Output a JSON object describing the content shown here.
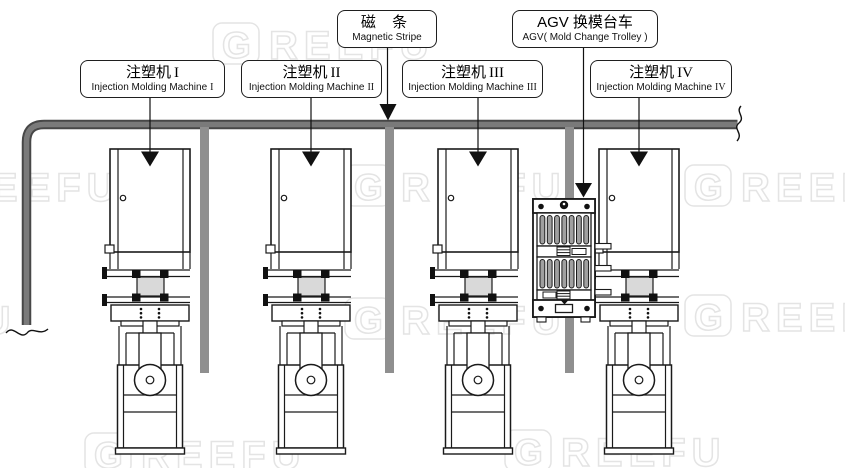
{
  "labels": {
    "magnetic_stripe": {
      "zh": "磁 条",
      "en": "Magnetic Stripe"
    },
    "agv_trolley": {
      "zh": "AGV 换模台车",
      "en": "AGV( Mold Change Trolley )"
    },
    "machines": [
      {
        "zh": "注塑机",
        "numeral": "I",
        "en": "Injection Molding Machine",
        "numeral_en": "I"
      },
      {
        "zh": "注塑机",
        "numeral": "II",
        "en": "Injection Molding Machine",
        "numeral_en": "II"
      },
      {
        "zh": "注塑机",
        "numeral": "III",
        "en": "Injection Molding Machine",
        "numeral_en": "III"
      },
      {
        "zh": "注塑机",
        "numeral": "IV",
        "en": "Injection Molding Machine",
        "numeral_en": "IV"
      }
    ]
  },
  "watermark": {
    "logo_letter": "G",
    "text": "REEFU"
  },
  "icons": {
    "junction_arrow": "down-arrow",
    "label_pointer_arrow": "down-arrow",
    "path_end": "squiggle-break-mark",
    "trolley_deck": "roller-conveyor"
  },
  "colors": {
    "magnetic_path_edge": "#474747",
    "magnetic_path_core": "#7a7a7a",
    "branch_stripe": "#8f8f8f",
    "mold_fill": "#d9d9d9",
    "roller_fill": "#a0a0a0",
    "line": "#1a1a1a",
    "watermark": "#e4e4e4"
  }
}
